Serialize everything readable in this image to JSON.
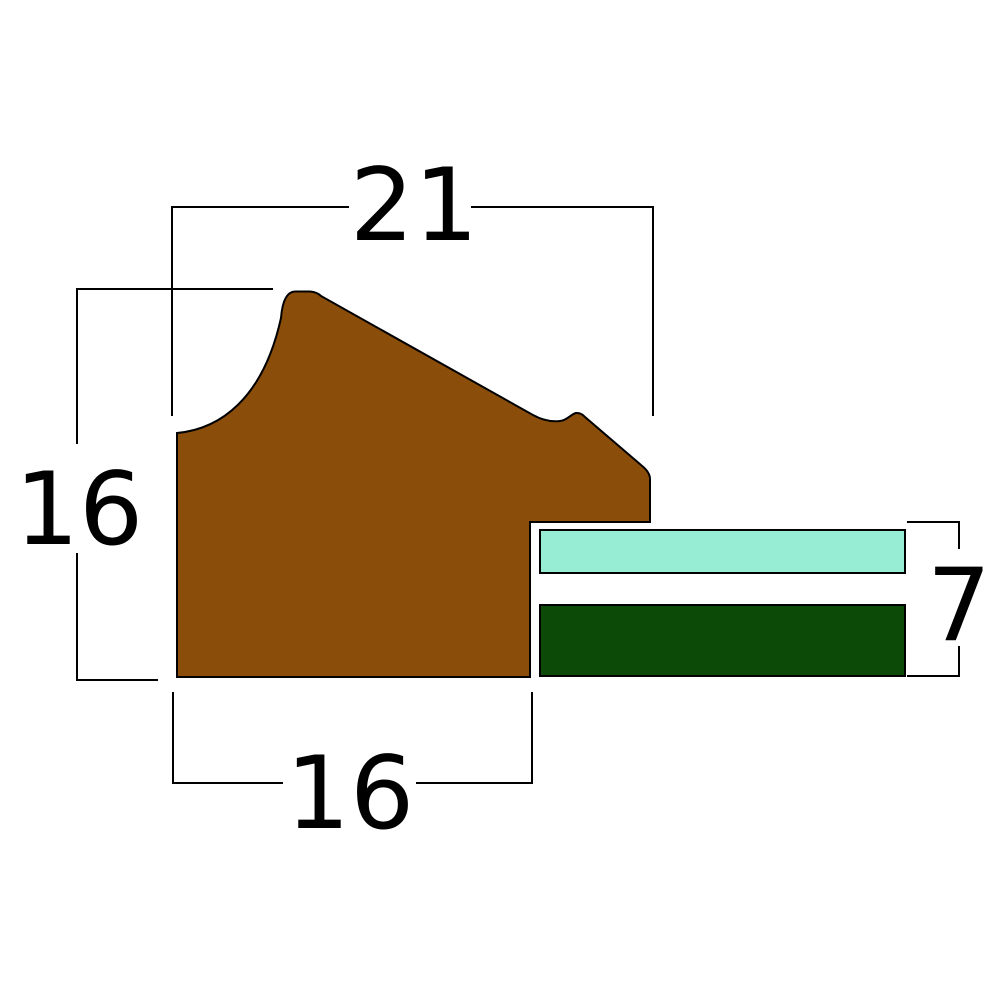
{
  "diagram": {
    "background": "#ffffff",
    "stroke_color": "#000000",
    "label_color": "#000000",
    "dimensions": {
      "overall_width": {
        "label": "21"
      },
      "overall_height": {
        "label": "16"
      },
      "base_width": {
        "label": "16"
      },
      "stack_height": {
        "label": "7"
      }
    },
    "shapes": {
      "moulding": {
        "fill": "#8B4D0A"
      },
      "glazing": {
        "fill": "#97EDD3"
      },
      "backing": {
        "fill": "#0C4A07"
      }
    }
  }
}
